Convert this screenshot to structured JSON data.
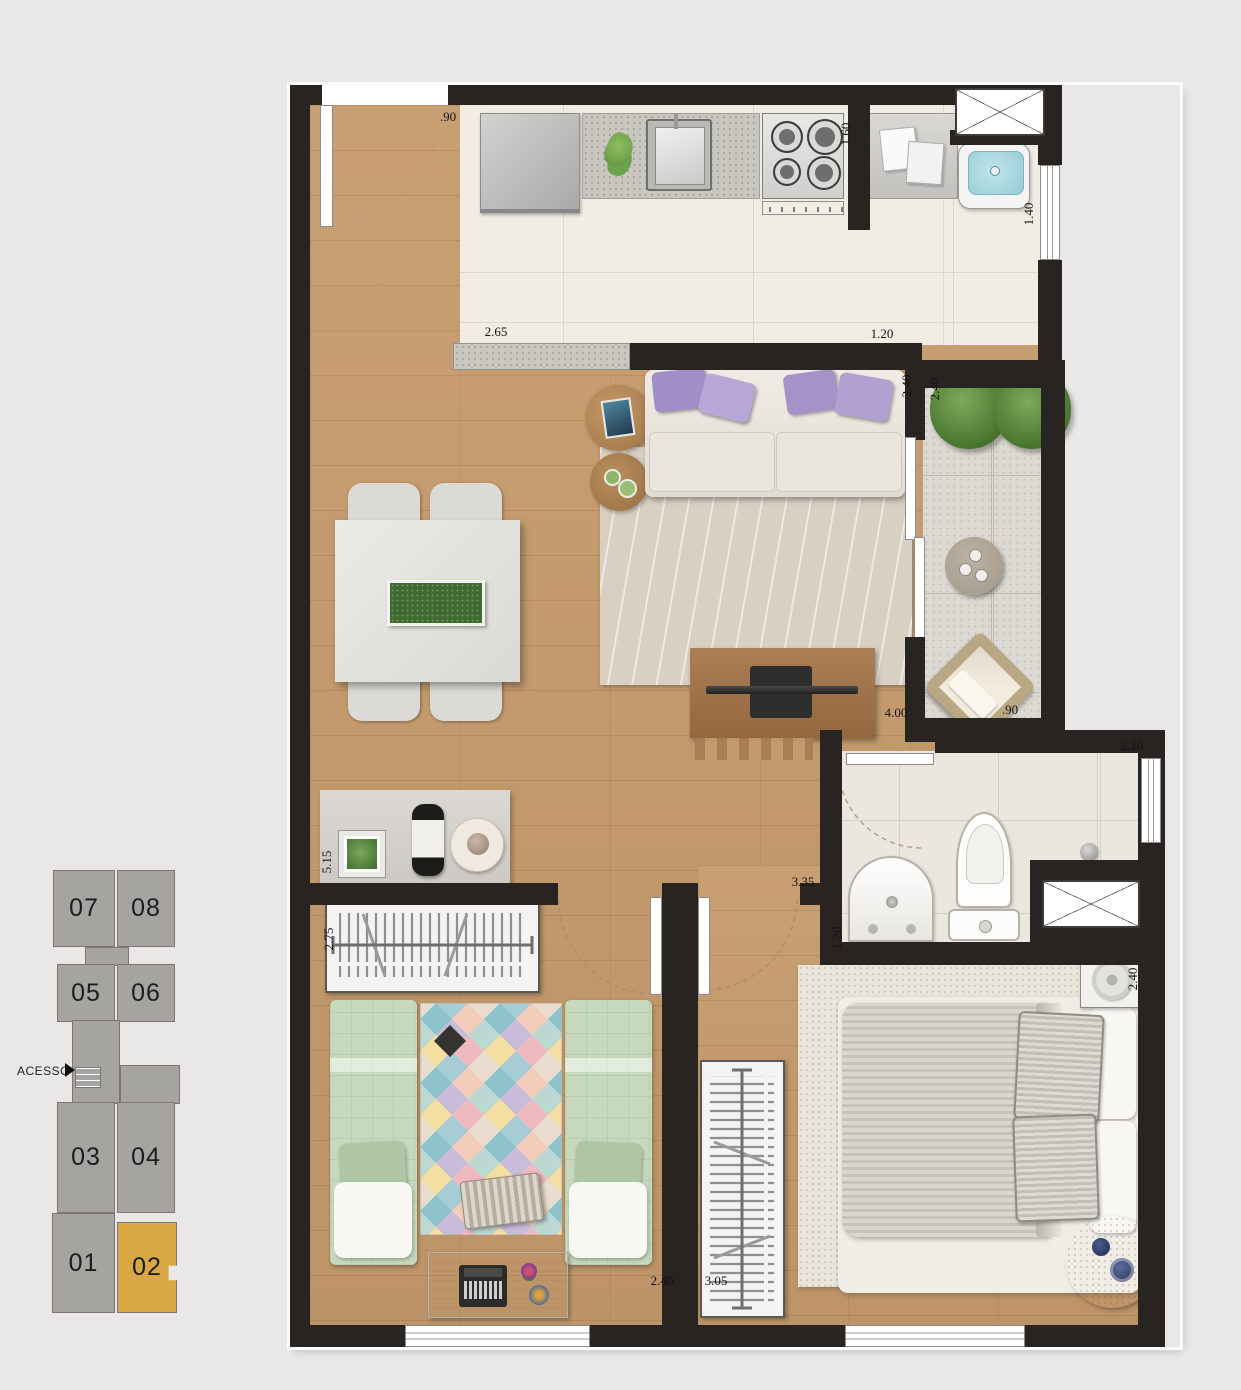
{
  "key_plan": {
    "access_label": "ACESSO",
    "units": [
      {
        "id": "07",
        "label": "07",
        "highlighted": false
      },
      {
        "id": "08",
        "label": "08",
        "highlighted": false
      },
      {
        "id": "05",
        "label": "05",
        "highlighted": false
      },
      {
        "id": "06",
        "label": "06",
        "highlighted": false
      },
      {
        "id": "03",
        "label": "03",
        "highlighted": false
      },
      {
        "id": "04",
        "label": "04",
        "highlighted": false
      },
      {
        "id": "01",
        "label": "01",
        "highlighted": false
      },
      {
        "id": "02",
        "label": "02",
        "highlighted": true
      }
    ],
    "colors": {
      "unit_fill": "#a6a4a1",
      "highlight_fill": "#d8a845",
      "outline": "#7a7774"
    }
  },
  "floor_plan": {
    "dimensions": [
      {
        "id": "entry-width",
        "value": ".90",
        "orientation": "h"
      },
      {
        "id": "kitchen-counter-depth",
        "value": "1.60",
        "orientation": "v"
      },
      {
        "id": "laundry-depth",
        "value": "1.40",
        "orientation": "v"
      },
      {
        "id": "kitchen-width",
        "value": "2.65",
        "orientation": "h"
      },
      {
        "id": "laundry-width",
        "value": "1.20",
        "orientation": "h"
      },
      {
        "id": "living-opening-width",
        "value": "2.40",
        "orientation": "v"
      },
      {
        "id": "balcony-opening-width",
        "value": "2.40",
        "orientation": "v"
      },
      {
        "id": "living-length",
        "value": "4.00",
        "orientation": "h"
      },
      {
        "id": "balcony-width",
        "value": ".90",
        "orientation": "h"
      },
      {
        "id": "living-depth",
        "value": "5.15",
        "orientation": "v"
      },
      {
        "id": "bathroom-width",
        "value": "2.10",
        "orientation": "h"
      },
      {
        "id": "hall-length",
        "value": "3.35",
        "orientation": "h"
      },
      {
        "id": "bathroom-depth",
        "value": "1.20",
        "orientation": "v"
      },
      {
        "id": "bedroom1-depth",
        "value": "2.75",
        "orientation": "v"
      },
      {
        "id": "bedroom1-width",
        "value": "2.40",
        "orientation": "h"
      },
      {
        "id": "bedroom2-width",
        "value": "3.05",
        "orientation": "h"
      },
      {
        "id": "bedroom2-depth",
        "value": "2.40",
        "orientation": "v"
      }
    ],
    "colors": {
      "wall": "#282421",
      "wood_floor": "#c49b6e",
      "kitchen_tile": "#f1ede5",
      "balcony_tile": "#dcd9d2",
      "bath_tile": "#ece7de",
      "sofa_pillow_purple": "#a28fc7",
      "bed_green": "#c6d9bc",
      "background": "#e9e8e6"
    }
  }
}
